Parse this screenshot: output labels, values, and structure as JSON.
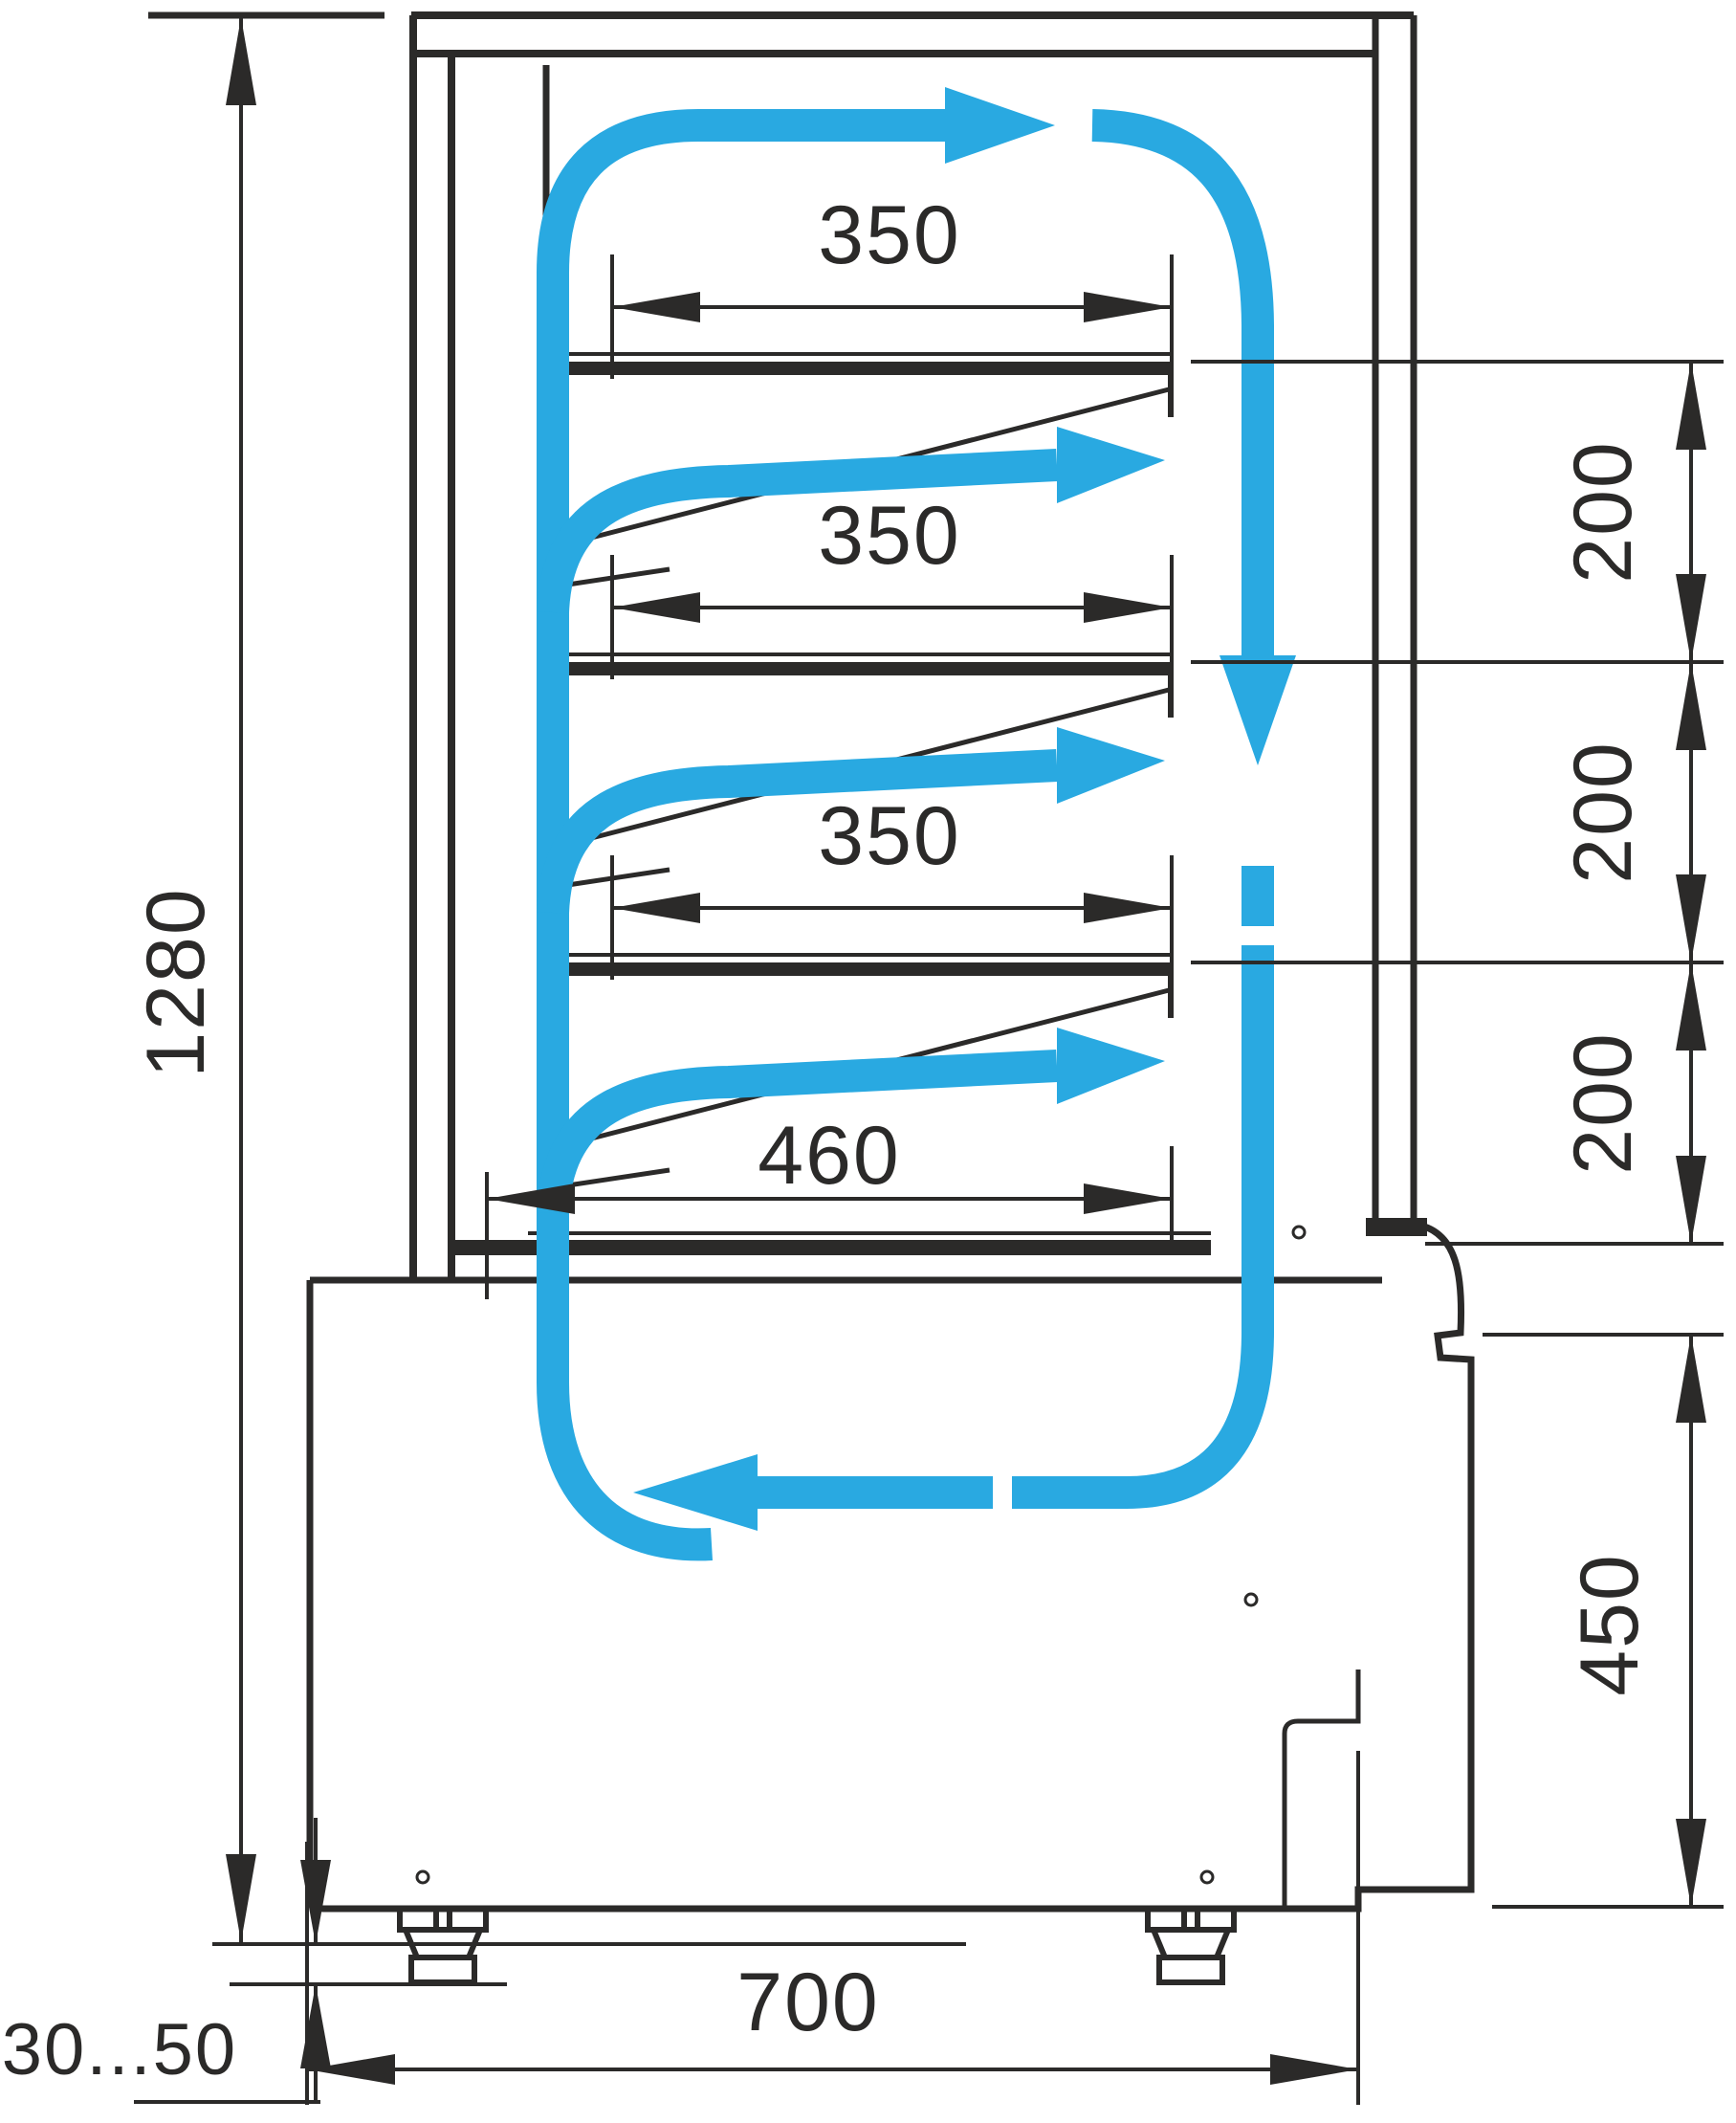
{
  "diagram": {
    "type": "technical-drawing",
    "subject": "refrigerated-display-case-side-cross-section-with-air-circulation",
    "colors": {
      "line": "#2b2a29",
      "airflow": "#29a9e1",
      "background": "#ffffff"
    },
    "dimensions": {
      "overall_height": "1280",
      "shelf_depth_1": "350",
      "shelf_depth_2": "350",
      "shelf_depth_3": "350",
      "shelf_gap_1": "200",
      "shelf_gap_2": "200",
      "shelf_gap_3": "200",
      "deck_depth": "460",
      "base_height": "450",
      "base_depth": "700",
      "foot_height_range": "30...50"
    }
  }
}
